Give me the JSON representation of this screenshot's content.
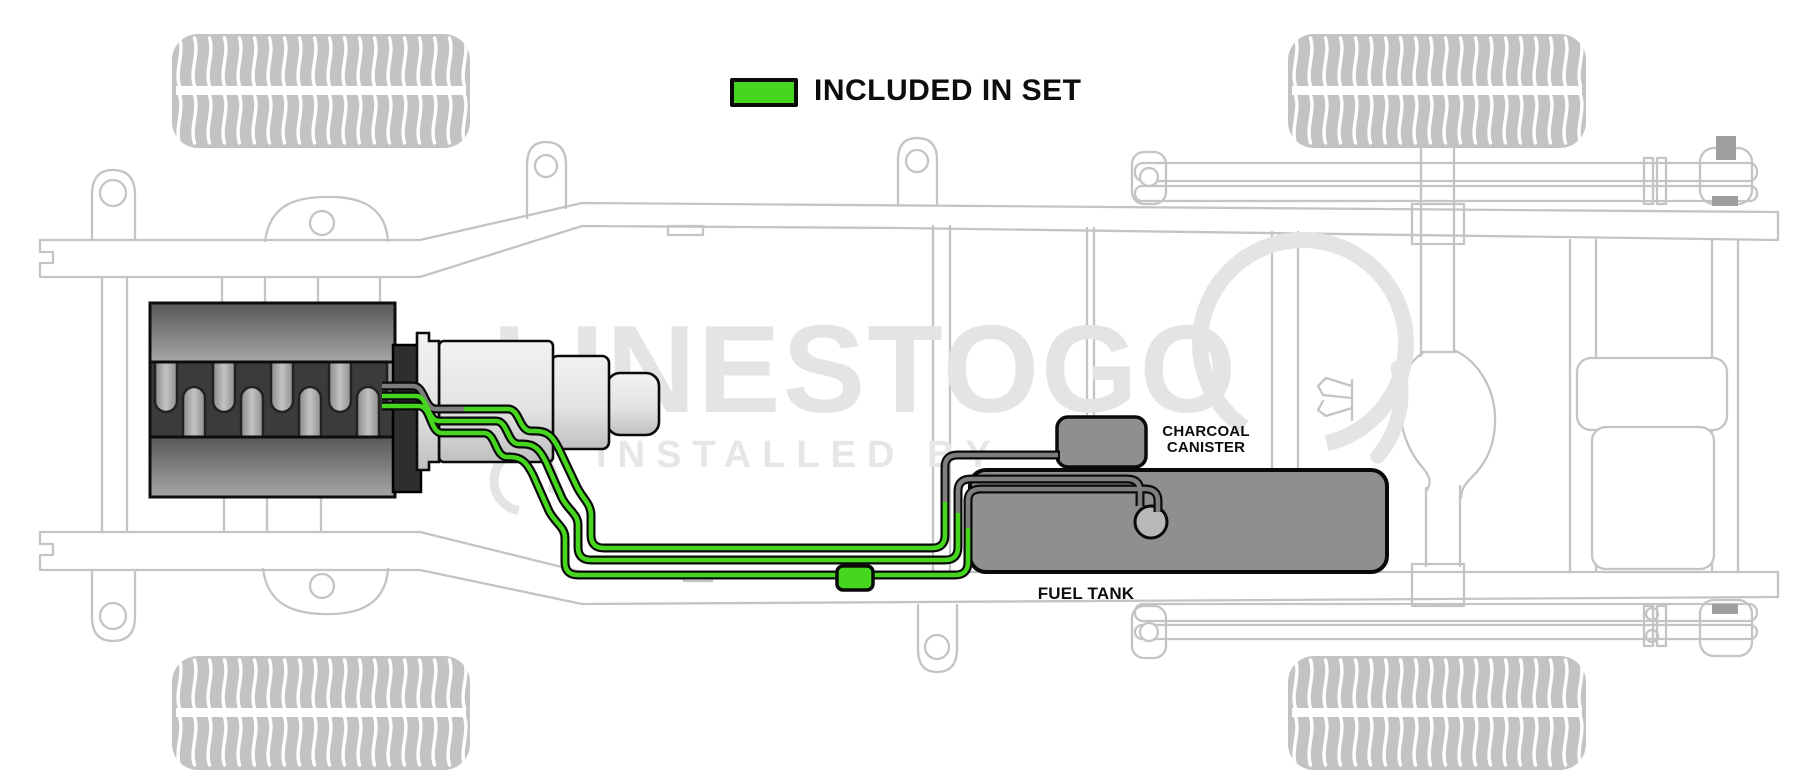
{
  "legend": {
    "label": "INCLUDED IN SET",
    "swatch_color": "#46d61e"
  },
  "diagram": {
    "labels": {
      "charcoal_canister": {
        "line1": "CHARCOAL",
        "line2": "CANISTER"
      },
      "fuel_tank": "FUEL TANK"
    },
    "watermark": {
      "brand": "LINESTOGO",
      "tagline": "INSTALLED BY"
    },
    "colors": {
      "included_line_green": "#46d61e",
      "existing_line_gray": "#7e7e7e",
      "line_outline": "#0a0a0a",
      "frame_outline": "#c4c4c4",
      "tank_fill": "#8f8f8f",
      "watermark_gray": "#e4e4e4"
    }
  }
}
